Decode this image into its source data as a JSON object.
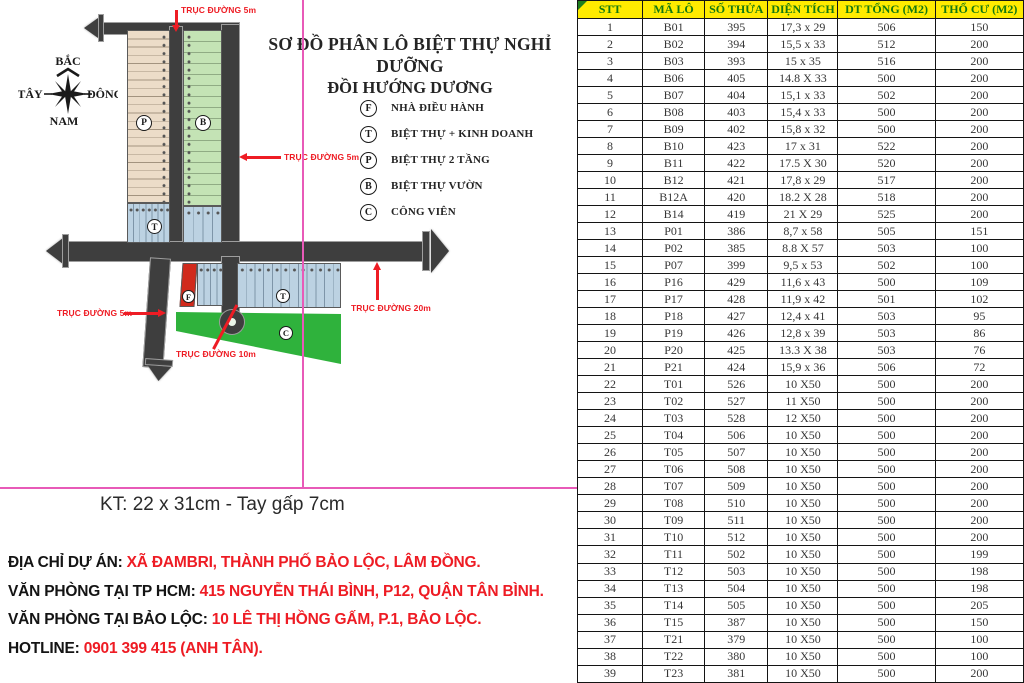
{
  "map": {
    "title_line1": "SƠ ĐỒ PHÂN LÔ BIỆT THỰ NGHỈ DƯỠNG",
    "title_line2": "ĐỒI HƯỚNG DƯƠNG",
    "compass": {
      "north": "BẮC",
      "south": "NAM",
      "east": "ĐÔNG",
      "west": "TÂY"
    },
    "legend": [
      {
        "symbol": "F",
        "label": "NHÀ ĐIỀU HÀNH"
      },
      {
        "symbol": "T",
        "label": "BIỆT THỰ + KINH DOANH"
      },
      {
        "symbol": "P",
        "label": "BIỆT THỰ 2 TẦNG"
      },
      {
        "symbol": "B",
        "label": "BIỆT THỰ VƯỜN"
      },
      {
        "symbol": "C",
        "label": "CÔNG VIÊN"
      }
    ],
    "road_labels": {
      "top": "TRỤC ĐƯỜNG 5m",
      "right": "TRỤC ĐƯỜNG 5m",
      "left": "TRỤC ĐƯỜNG 5m",
      "mid": "TRỤC ĐƯỜNG 10m",
      "bottom": "TRỤC ĐƯỜNG 20m"
    },
    "zone_letters": {
      "p": "P",
      "b": "B",
      "t_left": "T",
      "f": "F",
      "t_row": "T",
      "c": "C"
    }
  },
  "print_note": "KT: 22 x 31cm - Tay gấp 7cm",
  "contact": {
    "lines": [
      {
        "label": "ĐỊA CHỈ DỰ ÁN:",
        "value": "XÃ ĐAMBRI, THÀNH PHỐ BẢO LỘC, LÂM ĐỒNG."
      },
      {
        "label": "VĂN PHÒNG TẠI TP HCM:",
        "value": "415 NGUYỄN THÁI BÌNH, P12, QUẬN TÂN BÌNH."
      },
      {
        "label": "VĂN PHÒNG TẠI BẢO LỘC:",
        "value": "10 LÊ THỊ HỒNG GẤM, P.1, BẢO LỘC."
      },
      {
        "label": "HOTLINE:",
        "value": "0901 399 415 (ANH TÂN)."
      }
    ]
  },
  "table": {
    "headers": [
      "STT",
      "MÃ LÔ",
      "SỐ THỬA",
      "DIỆN TÍCH",
      "DT TỔNG (M2)",
      "THỔ CƯ (M2)"
    ],
    "rows": [
      [
        "1",
        "B01",
        "395",
        "17,3 x 29",
        "506",
        "150"
      ],
      [
        "2",
        "B02",
        "394",
        "15,5 x 33",
        "512",
        "200"
      ],
      [
        "3",
        "B03",
        "393",
        "15 x 35",
        "516",
        "200"
      ],
      [
        "4",
        "B06",
        "405",
        "14.8 X 33",
        "500",
        "200"
      ],
      [
        "5",
        "B07",
        "404",
        "15,1 x 33",
        "502",
        "200"
      ],
      [
        "6",
        "B08",
        "403",
        "15,4 x 33",
        "500",
        "200"
      ],
      [
        "7",
        "B09",
        "402",
        "15,8 x 32",
        "500",
        "200"
      ],
      [
        "8",
        "B10",
        "423",
        "17 x 31",
        "522",
        "200"
      ],
      [
        "9",
        "B11",
        "422",
        "17.5 X 30",
        "520",
        "200"
      ],
      [
        "10",
        "B12",
        "421",
        "17,8 x 29",
        "517",
        "200"
      ],
      [
        "11",
        "B12A",
        "420",
        "18.2 X 28",
        "518",
        "200"
      ],
      [
        "12",
        "B14",
        "419",
        "21 X 29",
        "525",
        "200"
      ],
      [
        "13",
        "P01",
        "386",
        "8,7 x 58",
        "505",
        "151"
      ],
      [
        "14",
        "P02",
        "385",
        "8.8 X 57",
        "503",
        "100"
      ],
      [
        "15",
        "P07",
        "399",
        "9,5 x 53",
        "502",
        "100"
      ],
      [
        "16",
        "P16",
        "429",
        "11,6 x 43",
        "500",
        "109"
      ],
      [
        "17",
        "P17",
        "428",
        "11,9 x 42",
        "501",
        "102"
      ],
      [
        "18",
        "P18",
        "427",
        "12,4 x 41",
        "503",
        "95"
      ],
      [
        "19",
        "P19",
        "426",
        "12,8 x 39",
        "503",
        "86"
      ],
      [
        "20",
        "P20",
        "425",
        "13.3 X 38",
        "503",
        "76"
      ],
      [
        "21",
        "P21",
        "424",
        "15,9 x 36",
        "506",
        "72"
      ],
      [
        "22",
        "T01",
        "526",
        "10 X50",
        "500",
        "200"
      ],
      [
        "23",
        "T02",
        "527",
        "11 X50",
        "500",
        "200"
      ],
      [
        "24",
        "T03",
        "528",
        "12 X50",
        "500",
        "200"
      ],
      [
        "25",
        "T04",
        "506",
        "10 X50",
        "500",
        "200"
      ],
      [
        "26",
        "T05",
        "507",
        "10 X50",
        "500",
        "200"
      ],
      [
        "27",
        "T06",
        "508",
        "10 X50",
        "500",
        "200"
      ],
      [
        "28",
        "T07",
        "509",
        "10 X50",
        "500",
        "200"
      ],
      [
        "29",
        "T08",
        "510",
        "10 X50",
        "500",
        "200"
      ],
      [
        "30",
        "T09",
        "511",
        "10 X50",
        "500",
        "200"
      ],
      [
        "31",
        "T10",
        "512",
        "10 X50",
        "500",
        "200"
      ],
      [
        "32",
        "T11",
        "502",
        "10 X50",
        "500",
        "199"
      ],
      [
        "33",
        "T12",
        "503",
        "10 X50",
        "500",
        "198"
      ],
      [
        "34",
        "T13",
        "504",
        "10 X50",
        "500",
        "198"
      ],
      [
        "35",
        "T14",
        "505",
        "10 X50",
        "500",
        "205"
      ],
      [
        "36",
        "T15",
        "387",
        "10 X50",
        "500",
        "150"
      ],
      [
        "37",
        "T21",
        "379",
        "10 X50",
        "500",
        "100"
      ],
      [
        "38",
        "T22",
        "380",
        "10 X50",
        "500",
        "100"
      ],
      [
        "39",
        "T23",
        "381",
        "10 X50",
        "500",
        "200"
      ]
    ]
  },
  "colors": {
    "accent_red": "#ee1c24",
    "magenta_guide": "#e85ab8",
    "table_header_bg": "#ffeb00",
    "table_header_text": "#15790f",
    "park_green": "#2fb23c",
    "road": "#3e3e3e",
    "zone_tan": "#ecdcc8",
    "zone_green": "#c4e3b5",
    "zone_blue": "#bcd2e2",
    "office_red": "#d12a1c"
  }
}
